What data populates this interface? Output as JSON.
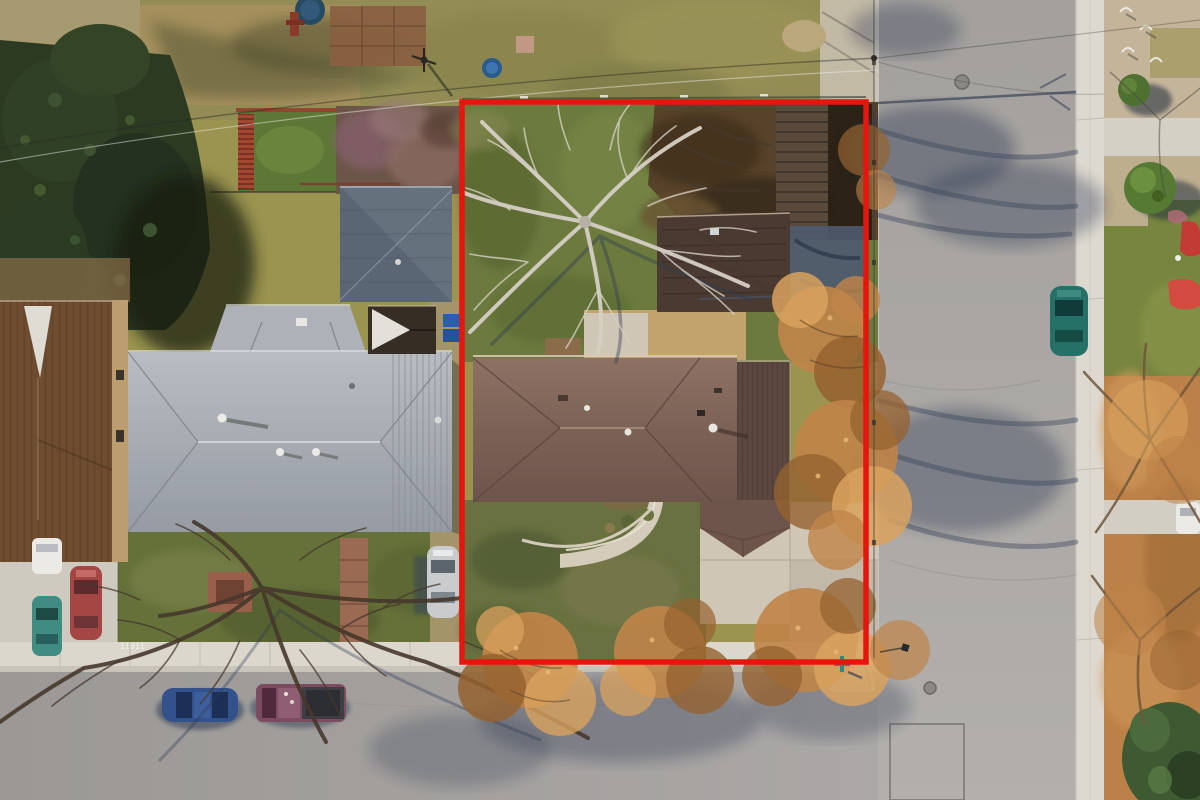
{
  "scene": {
    "description": "Aerial top-down drone photograph of a residential corner lot outlined with a red property boundary; winter bare trees, neighboring houses, intersecting streets",
    "curb_number": "11911"
  },
  "boundary": {
    "color": "#e8150f",
    "shape": "rectangle outline around subject lot"
  },
  "objects": {
    "subject_lot": [
      "green back lawn",
      "large bare tree",
      "tilled dirt garden",
      "wood slat deck",
      "detached garage roof",
      "brown hip-roof house",
      "curved front walkway",
      "concrete driveway patio",
      "front lawn with orange-leaf trees"
    ],
    "neighbors": [
      "large gray hip-roof house",
      "slate blue-gray roof house",
      "brown roof house at far left",
      "conifer trees",
      "lilac shrub row",
      "fenced garden with red trellis",
      "trampoline"
    ],
    "streets": [
      "vertical street on right",
      "horizontal street at bottom",
      "intersection corner with street-name sign",
      "white gutter and sidewalk strips",
      "manhole covers",
      "utility patch outline"
    ],
    "vehicles": [
      "silver car in neighbor driveway",
      "blue sedan parked on street",
      "maroon pickup truck parked on street",
      "teal car on right street",
      "white car on right driveway",
      "red car, teal car and white car in far-left driveway"
    ],
    "right_parkway": [
      "gravel yard with wickets",
      "round green bushes",
      "red picnic blanket",
      "orange leaf-litter parkway",
      "bare trees",
      "dark green juniper"
    ]
  },
  "colors": {
    "asphalt": "#a7a4a1",
    "sidewalk": "#dcd7cd",
    "curb": "#c9c4ba",
    "lawn_green": "#6c7a3e",
    "lawn_olive": "#938d55",
    "dirt": "#57422a",
    "gravel": "#c2a36c",
    "concrete_pad": "#cfc6b5",
    "deck_wood": "#7c5d3c",
    "roof_brown": "#83685c",
    "roof_brown_dark": "#5e4941",
    "garage_roof": "#4a3a31",
    "roof_gray": "#aab0b6",
    "roof_slate": "#5a6673",
    "roof_espresso": "#362d24",
    "roof_left_brown": "#6f4d30",
    "conifer": "#2c3a22",
    "foliage_orange": "#c08448",
    "foliage_orange_light": "#d9a25e",
    "foliage_orange_dark": "#95622f",
    "shadow_blue": "#2e3b55",
    "tree_bare_light": "#d6cfc5",
    "tree_bare_dark": "#46382c",
    "boundary_red": "#e8150f",
    "car_blue": "#33518c",
    "car_maroon": "#7d4b60",
    "car_teal": "#257067",
    "car_red": "#a34644",
    "car_silver": "#c9cbcd",
    "car_white": "#eceae5",
    "bin_blue": "#2a5fae",
    "sign_teal": "#2e8a7a",
    "brick": "#9a6a52",
    "juniper": "#3f5a33"
  }
}
